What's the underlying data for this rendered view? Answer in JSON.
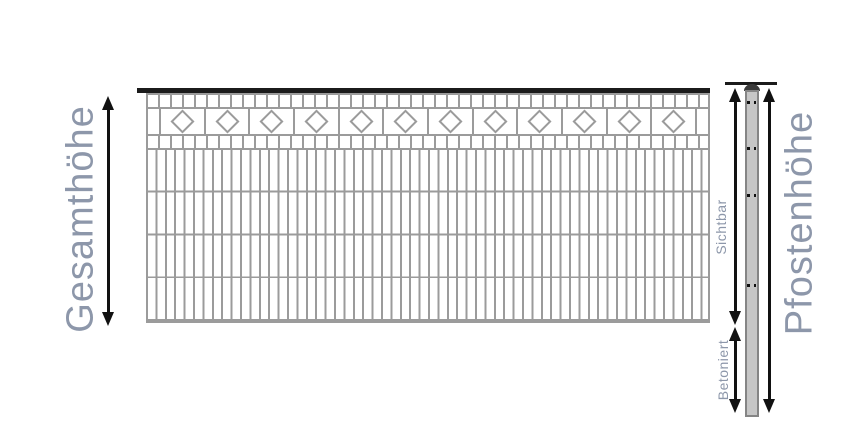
{
  "diagram": {
    "left_dimension_label": "Gesamthöhe",
    "right_dimension_label": "Pfostenhöhe",
    "post_visible_label": "Sichtbar",
    "post_concreted_label": "Betoniert"
  },
  "fence": {
    "ornament": "diamond",
    "diamond_count": 12,
    "body_rows": 4,
    "body_columns": 60
  },
  "post": {
    "hole_pair_positions_y": [
      101,
      147,
      194,
      284
    ]
  },
  "colors": {
    "label_text": "#8d97aa",
    "wire_gray": "#9b9b9b",
    "top_bar_black": "#1b1b1b",
    "arrow_black": "#111111",
    "post_fill": "#c6c6c6",
    "post_border": "#858585",
    "post_cap": "#3a3a3a",
    "post_hole": "#111111",
    "page_bg": "#ffffff"
  }
}
